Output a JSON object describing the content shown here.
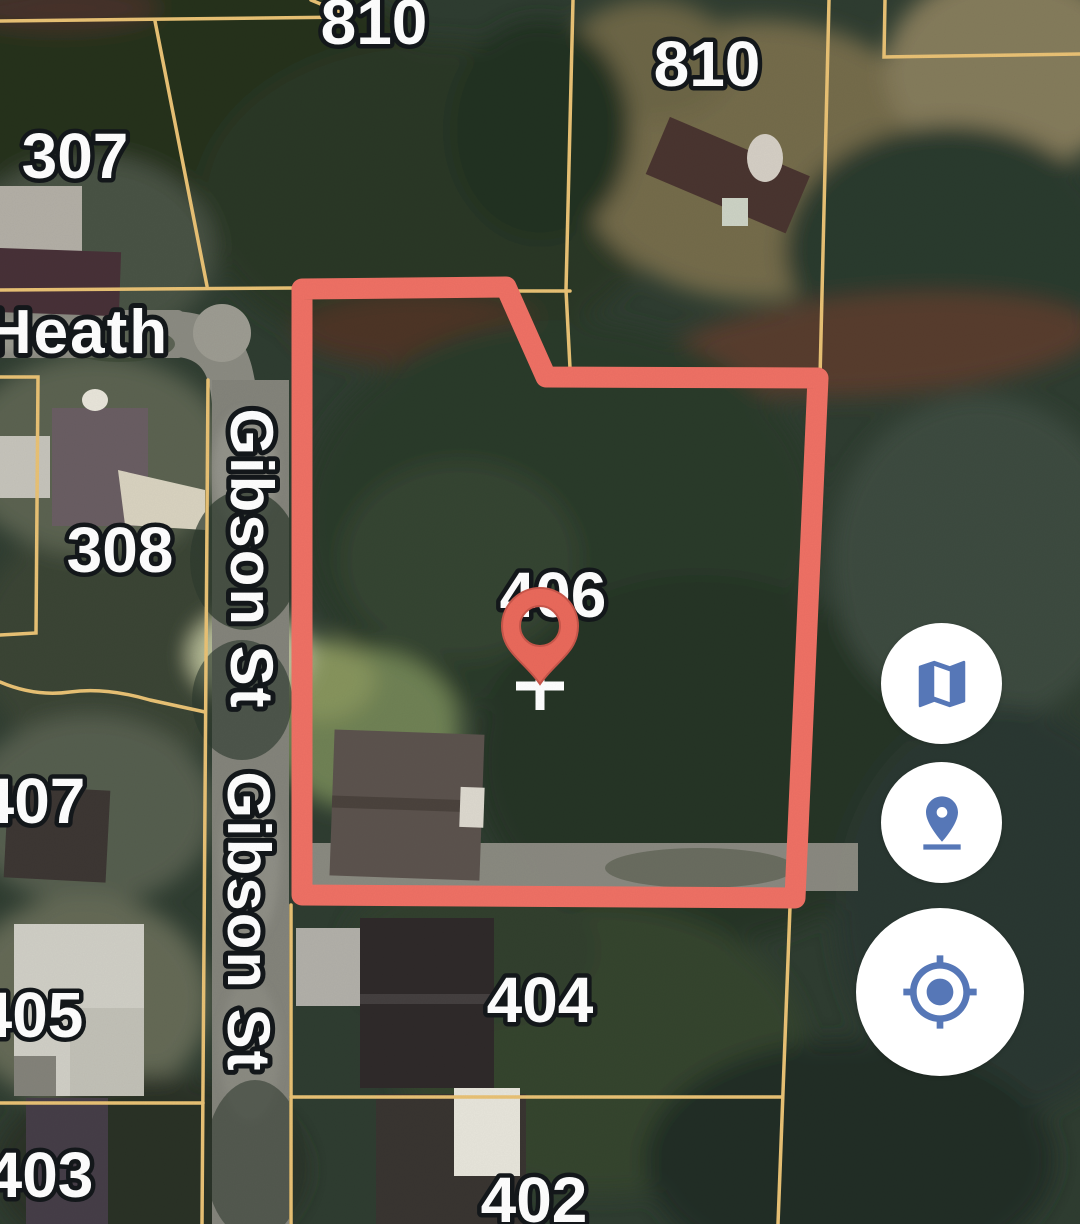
{
  "map": {
    "view": "satellite",
    "selected_parcel": "406",
    "parcel_labels": [
      {
        "id": "810-top",
        "text": "810"
      },
      {
        "id": "810-right",
        "text": "810"
      },
      {
        "id": "307",
        "text": "307"
      },
      {
        "id": "308",
        "text": "308"
      },
      {
        "id": "406",
        "text": "406"
      },
      {
        "id": "407",
        "text": "407"
      },
      {
        "id": "405",
        "text": "405"
      },
      {
        "id": "403",
        "text": "403"
      },
      {
        "id": "404",
        "text": "404"
      },
      {
        "id": "402",
        "text": "402"
      }
    ],
    "street_labels": [
      {
        "id": "heath",
        "text": "Heath"
      },
      {
        "id": "gibson-upper",
        "text": "Gibson St"
      },
      {
        "id": "gibson-lower",
        "text": "Gibson St"
      }
    ],
    "marker": {
      "type": "dropped-pin",
      "on_parcel": "406"
    },
    "colors": {
      "boundary_red": "#ef7165",
      "parcel_line_orange": "#e9c275",
      "pin_red": "#ea6a5c",
      "label_fill": "#ffffff",
      "label_outline": "#14181b",
      "control_icon_blue": "#5677b7",
      "control_background": "#ffffff"
    }
  },
  "controls": {
    "buttons": [
      {
        "id": "map-view",
        "icon": "map-icon"
      },
      {
        "id": "dropped-pin",
        "icon": "pin-drop-icon"
      },
      {
        "id": "my-location",
        "icon": "my-location-icon"
      }
    ]
  }
}
